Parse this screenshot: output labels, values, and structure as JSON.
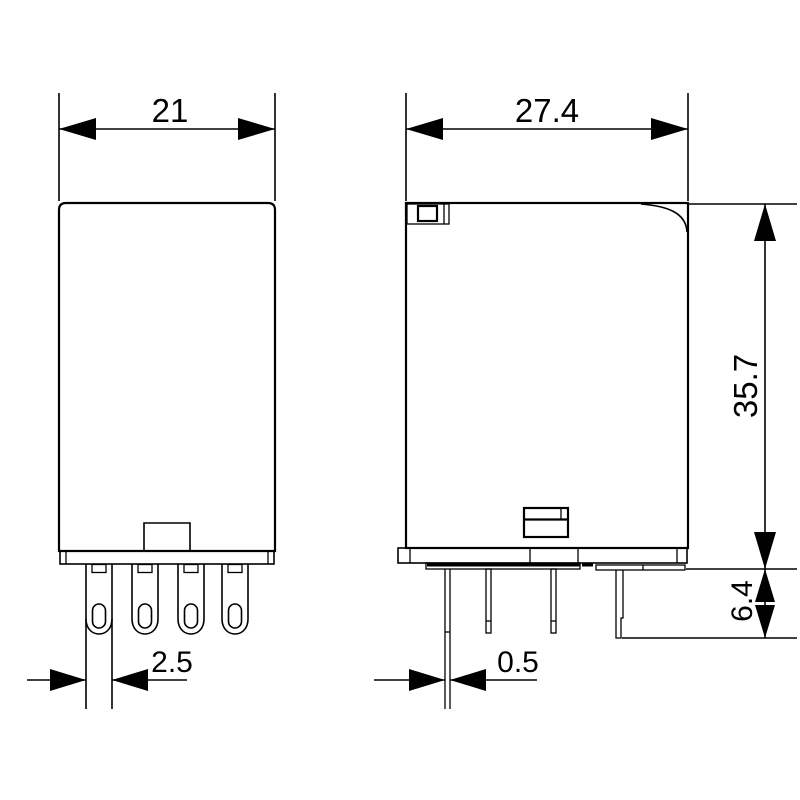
{
  "drawing": {
    "type": "technical-dimension-drawing",
    "background_color": "#ffffff",
    "line_color": "#000000",
    "views": {
      "front": {
        "name": "front view",
        "dims": {
          "width": "21",
          "pin_width": "2.5"
        }
      },
      "side": {
        "name": "side view",
        "dims": {
          "width": "27.4",
          "height": "35.7",
          "pin_length": "6.4",
          "pin_thickness": "0.5"
        }
      }
    }
  }
}
